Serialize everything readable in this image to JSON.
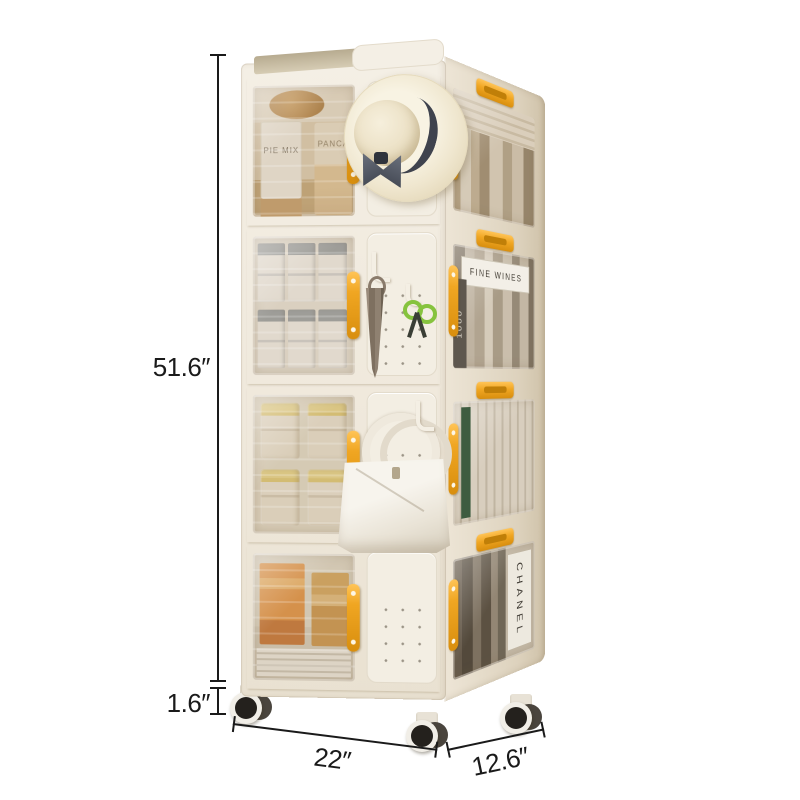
{
  "annotations": {
    "height_label": "51.6″",
    "caster_height_label": "1.6″",
    "width_label": "22″",
    "depth_label": "12.6″"
  },
  "cabinet": {
    "labels": {
      "pie_mix": "PIE MIX",
      "pancake": "PANCA",
      "fine_wines": "FINE WINES",
      "thousand": "1000",
      "chanel": "CHANEL"
    }
  },
  "colors": {
    "background": "#FFFFFF",
    "line_color": "#1A1A1A",
    "body": "#F0EADF",
    "side_face": "#E3D9C6",
    "accent_yellow": "#F0A622",
    "accent_yellow_dark": "#D88E0E",
    "window_tint": "rgba(168,147,112,0.30)",
    "wheel_black": "#24211D",
    "hat_cream": "#F3ECD9",
    "ribbon_dark": "#3F434E"
  }
}
